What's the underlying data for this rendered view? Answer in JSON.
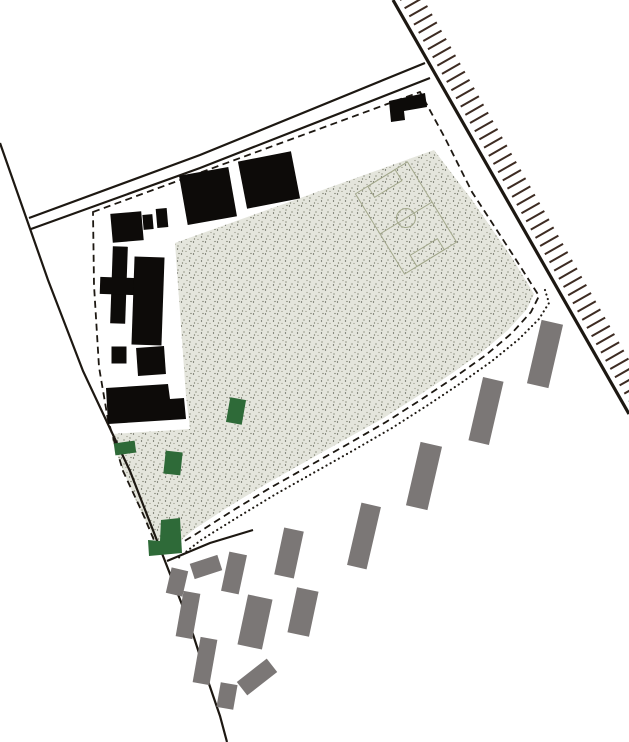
{
  "canvas": {
    "width": 629,
    "height": 742,
    "background": "#ffffff"
  },
  "colors": {
    "background": "#ffffff",
    "line": "#1d1812",
    "railway_tick": "#3d2b22",
    "field_fill": "#e4e5dc",
    "field_dot_dark": "#45473c",
    "field_dot_mid": "#6f7160",
    "field_dot_light": "#9a9c8b",
    "pitch_line": "#a3a88c",
    "building_black": "#0d0b09",
    "building_green": "#2e6a38",
    "building_gray": "#7b7776"
  },
  "railway": {
    "line": {
      "x1": 393,
      "y1": 0,
      "x2": 629,
      "y2": 414
    },
    "line_width": 3.2,
    "tick": {
      "gap": 6,
      "length": 21,
      "spacing": 8.2,
      "width": 2,
      "dx_per_dy": 0.57
    }
  },
  "roads": {
    "line_width": 2.2,
    "upper": [
      [
        29,
        218
      ],
      [
        200,
        155
      ],
      [
        425,
        63
      ]
    ],
    "lower": [
      [
        31,
        229
      ],
      [
        200,
        168
      ],
      [
        430,
        78
      ]
    ],
    "west": [
      [
        0,
        143
      ],
      [
        48,
        280
      ],
      [
        83,
        371
      ],
      [
        130,
        471
      ],
      [
        163,
        556
      ],
      [
        190,
        625
      ],
      [
        207,
        678
      ],
      [
        220,
        716
      ],
      [
        227,
        742
      ]
    ],
    "kerb": [
      [
        167,
        561
      ],
      [
        210,
        543
      ],
      [
        253,
        530
      ]
    ]
  },
  "site_boundary": {
    "dashed_width": 1.8,
    "dash_pattern": "7 4.5",
    "dashed_points": [
      [
        93,
        212
      ],
      [
        420,
        92
      ],
      [
        445,
        138
      ],
      [
        472,
        192
      ],
      [
        513,
        255
      ],
      [
        539,
        296
      ],
      [
        531,
        312
      ],
      [
        512,
        333
      ],
      [
        486,
        355
      ],
      [
        455,
        377
      ],
      [
        422,
        399
      ],
      [
        386,
        422
      ],
      [
        348,
        444
      ],
      [
        309,
        466
      ],
      [
        270,
        488
      ],
      [
        232,
        511
      ],
      [
        196,
        534
      ],
      [
        168,
        551
      ],
      [
        156,
        545
      ],
      [
        143,
        514
      ],
      [
        123,
        471
      ],
      [
        108,
        420
      ],
      [
        99,
        367
      ],
      [
        94,
        285
      ]
    ],
    "dotted_width": 2.1,
    "dotted_pattern": "0.1 4.6",
    "dotted_points": [
      [
        545,
        290
      ],
      [
        549,
        303
      ],
      [
        539,
        319
      ],
      [
        519,
        339
      ],
      [
        492,
        361
      ],
      [
        461,
        383
      ],
      [
        428,
        405
      ],
      [
        392,
        428
      ],
      [
        354,
        450
      ],
      [
        315,
        472
      ],
      [
        276,
        494
      ],
      [
        238,
        517
      ],
      [
        201,
        540
      ],
      [
        177,
        559
      ]
    ]
  },
  "field": {
    "outline_points": [
      [
        175,
        243
      ],
      [
        434,
        150
      ],
      [
        472,
        200
      ],
      [
        512,
        258
      ],
      [
        534,
        294
      ],
      [
        527,
        309
      ],
      [
        508,
        330
      ],
      [
        482,
        352
      ],
      [
        451,
        374
      ],
      [
        418,
        396
      ],
      [
        382,
        419
      ],
      [
        344,
        440
      ],
      [
        305,
        462
      ],
      [
        266,
        484
      ],
      [
        228,
        507
      ],
      [
        193,
        530
      ],
      [
        172,
        548
      ],
      [
        155,
        540
      ],
      [
        140,
        510
      ],
      [
        122,
        468
      ],
      [
        112,
        440
      ],
      [
        112,
        434
      ],
      [
        190,
        429
      ],
      [
        186,
        396
      ]
    ],
    "dot_tile": 12,
    "dots": [
      [
        1.5,
        2,
        "dark"
      ],
      [
        4,
        8,
        "mid"
      ],
      [
        7,
        4.5,
        "light"
      ],
      [
        9.5,
        9,
        "dark"
      ],
      [
        2.5,
        11,
        "mid"
      ],
      [
        11,
        1.5,
        "mid"
      ],
      [
        6,
        11.5,
        "light"
      ],
      [
        10,
        6,
        "mid"
      ]
    ],
    "dot_radius": 0.65
  },
  "pitch": {
    "cx": 406,
    "cy": 218,
    "w": 61,
    "h": 94,
    "rot": -31.5,
    "line_width": 1,
    "center_circle_r": 9.5,
    "goal_box": {
      "w": 32,
      "d": 13
    }
  },
  "buildings": {
    "black_rects": [
      {
        "name": "black-building-hall-1",
        "cx": 208,
        "cy": 196,
        "w": 50,
        "h": 50,
        "rot": -10
      },
      {
        "name": "black-building-hall-2",
        "cx": 269,
        "cy": 180,
        "w": 54,
        "h": 48,
        "rot": -11
      },
      {
        "name": "black-building-l-main",
        "cx": 127,
        "cy": 227,
        "w": 31,
        "h": 29,
        "rot": -5
      },
      {
        "name": "black-building-l-wing",
        "cx": 148,
        "cy": 222,
        "w": 10,
        "h": 15,
        "rot": -5
      },
      {
        "name": "black-building-tick",
        "cx": 162,
        "cy": 218,
        "w": 11,
        "h": 19,
        "rot": -5
      },
      {
        "name": "black-building-bar-vert",
        "cx": 119,
        "cy": 285,
        "w": 15,
        "h": 77,
        "rot": 2
      },
      {
        "name": "black-building-bar-horiz",
        "cx": 118,
        "cy": 286,
        "w": 36,
        "h": 17,
        "rot": 2
      },
      {
        "name": "black-building-slab",
        "cx": 148,
        "cy": 301,
        "w": 30,
        "h": 88,
        "rot": 2
      },
      {
        "name": "black-building-square",
        "cx": 151,
        "cy": 361,
        "w": 28,
        "h": 28,
        "rot": -4
      },
      {
        "name": "black-building-small",
        "cx": 119,
        "cy": 355,
        "w": 15,
        "h": 17,
        "rot": 0
      }
    ],
    "black_polys": [
      {
        "name": "black-building-flag",
        "points": [
          [
            389,
            101
          ],
          [
            425,
            93
          ],
          [
            427,
            107
          ],
          [
            404,
            111
          ],
          [
            405,
            120
          ],
          [
            391,
            122
          ]
        ]
      },
      {
        "name": "black-building-stepped-slab",
        "points": [
          [
            106,
            388
          ],
          [
            168,
            384
          ],
          [
            170,
            399
          ],
          [
            184,
            398
          ],
          [
            186,
            419
          ],
          [
            108,
            424
          ]
        ]
      }
    ],
    "green_rects": [
      {
        "name": "green-building-1",
        "cx": 236,
        "cy": 411,
        "w": 16,
        "h": 25,
        "rot": 10
      },
      {
        "name": "green-building-2",
        "cx": 125,
        "cy": 448,
        "w": 21,
        "h": 12,
        "rot": -8
      },
      {
        "name": "green-building-3",
        "cx": 173,
        "cy": 463,
        "w": 17,
        "h": 23,
        "rot": 6
      }
    ],
    "green_polys": [
      {
        "name": "green-building-l",
        "points": [
          [
            161,
            520
          ],
          [
            180,
            518
          ],
          [
            182,
            553
          ],
          [
            149,
            556
          ],
          [
            148,
            540
          ],
          [
            160,
            541
          ]
        ]
      }
    ],
    "gray_rects": [
      {
        "name": "gray-slab-1",
        "cx": 177,
        "cy": 582,
        "w": 17,
        "h": 26,
        "rot": 13
      },
      {
        "name": "gray-slab-2",
        "cx": 206,
        "cy": 567,
        "w": 29,
        "h": 16,
        "rot": -18
      },
      {
        "name": "gray-slab-3",
        "cx": 188,
        "cy": 615,
        "w": 17,
        "h": 46,
        "rot": 10
      },
      {
        "name": "gray-slab-4",
        "cx": 205,
        "cy": 661,
        "w": 17,
        "h": 46,
        "rot": 10
      },
      {
        "name": "gray-slab-5",
        "cx": 227,
        "cy": 696,
        "w": 17,
        "h": 25,
        "rot": 10
      },
      {
        "name": "gray-slab-6",
        "cx": 234,
        "cy": 573,
        "w": 18,
        "h": 40,
        "rot": 12
      },
      {
        "name": "gray-slab-7",
        "cx": 255,
        "cy": 622,
        "w": 25,
        "h": 51,
        "rot": 12
      },
      {
        "name": "gray-slab-8",
        "cx": 257,
        "cy": 677,
        "w": 38,
        "h": 17,
        "rot": -38
      },
      {
        "name": "gray-slab-9",
        "cx": 289,
        "cy": 553,
        "w": 20,
        "h": 48,
        "rot": 12
      },
      {
        "name": "gray-slab-10",
        "cx": 303,
        "cy": 612,
        "w": 22,
        "h": 46,
        "rot": 12
      },
      {
        "name": "gray-slab-11",
        "cx": 364,
        "cy": 536,
        "w": 20,
        "h": 64,
        "rot": 13
      },
      {
        "name": "gray-slab-12",
        "cx": 424,
        "cy": 476,
        "w": 22,
        "h": 65,
        "rot": 13
      },
      {
        "name": "gray-slab-13",
        "cx": 486,
        "cy": 411,
        "w": 21,
        "h": 65,
        "rot": 13
      },
      {
        "name": "gray-slab-14",
        "cx": 545,
        "cy": 354,
        "w": 22,
        "h": 65,
        "rot": 13
      }
    ]
  }
}
